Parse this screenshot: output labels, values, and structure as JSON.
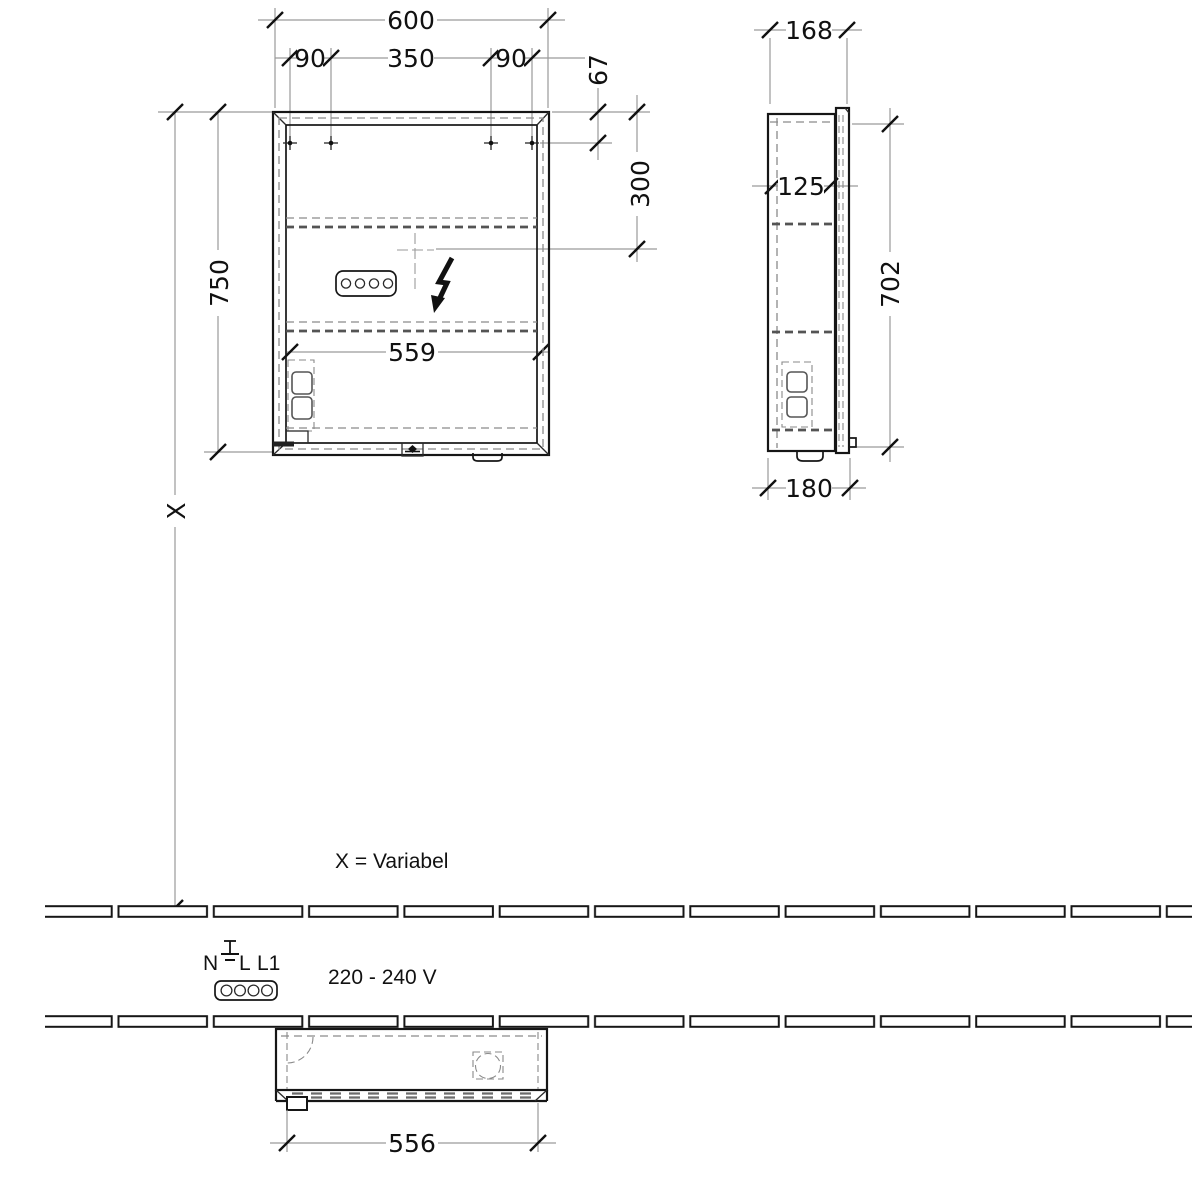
{
  "drawing": {
    "front_view": {
      "width": "600",
      "hole_offset_left": "90",
      "hole_spacing": "350",
      "hole_offset_right": "90",
      "top_to_holes": "67",
      "top_to_outlet": "300",
      "height": "750",
      "interior_width": "559",
      "wall_distance": "X"
    },
    "side_view": {
      "depth": "168",
      "interior_depth": "125",
      "height": "702",
      "total_depth": "180"
    },
    "bottom_view": {
      "door_width": "556"
    },
    "notes": {
      "variable_note": "X = Variabel",
      "voltage": "220 - 240 V",
      "terminal_n": "N",
      "terminal_l": "L",
      "terminal_l1": "L1"
    },
    "colors": {
      "line": "#161616",
      "dimension_line": "#9a9a9a",
      "hidden_line": "#8a8a8a"
    }
  }
}
